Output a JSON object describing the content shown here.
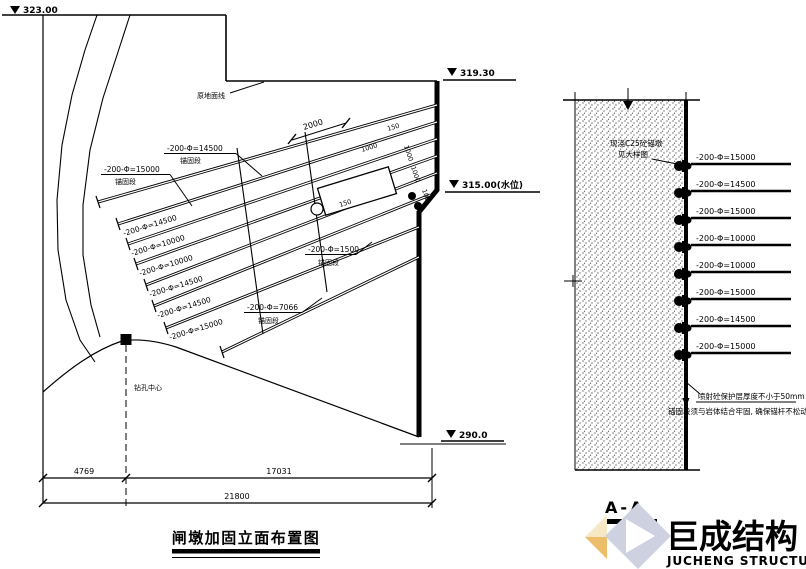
{
  "elevation": {
    "title": "闸墩加固立面布置图",
    "marker_ground": "323.00",
    "marker_platform": "319.30",
    "marker_mid": "315.00(水位)",
    "marker_base": "290.0",
    "ground_line_label": "原地面线",
    "borehole_label": "钻孔中心",
    "leader_labels": [
      {
        "spec": "-200-Φ=14500",
        "seg": "锚固段"
      },
      {
        "spec": "-200-Φ=15000",
        "seg": "锚固段"
      },
      {
        "spec": "-200-Φ=7066",
        "seg": "锚固段"
      },
      {
        "spec": "-200-Φ=1500",
        "seg": "锚固段"
      }
    ],
    "anchor_labels": [
      "-200-Φ=14500",
      "-200-Φ=10000",
      "-200-Φ=10000",
      "-200-Φ=14500",
      "-200-Φ=14500",
      "-200-Φ=15000"
    ],
    "small_dims": {
      "d2000": "2000",
      "d1000a": "1000",
      "d1000b": "1000",
      "d1000c": "1000",
      "d150a": "150",
      "d150b": "150",
      "d100": "100"
    },
    "dims": {
      "left": "4769",
      "right": "17031",
      "total": "21800"
    }
  },
  "section": {
    "title": "A-A",
    "top_note": [
      "现浇C25砼锚墩",
      "见大样图"
    ],
    "bottom_note": [
      "喷射砼保护层厚度不小于50mm",
      "锚固段须与岩体结合牢固, 确保锚杆不松动"
    ],
    "anchors": [
      "-200-Φ=15000",
      "-200-Φ=14500",
      "-200-Φ=15000",
      "-200-Φ=10000",
      "-200-Φ=10000",
      "-200-Φ=15000",
      "-200-Φ=14500",
      "-200-Φ=15000"
    ]
  },
  "logo": {
    "name_cn": "巨成结构",
    "name_en": "JUCHENG STRUCTURE",
    "text_color": "#c3c8d9",
    "mark_color": "#cdd1e0",
    "accent_color": "#ecbe6a",
    "accent_light": "#f6e8c4"
  }
}
